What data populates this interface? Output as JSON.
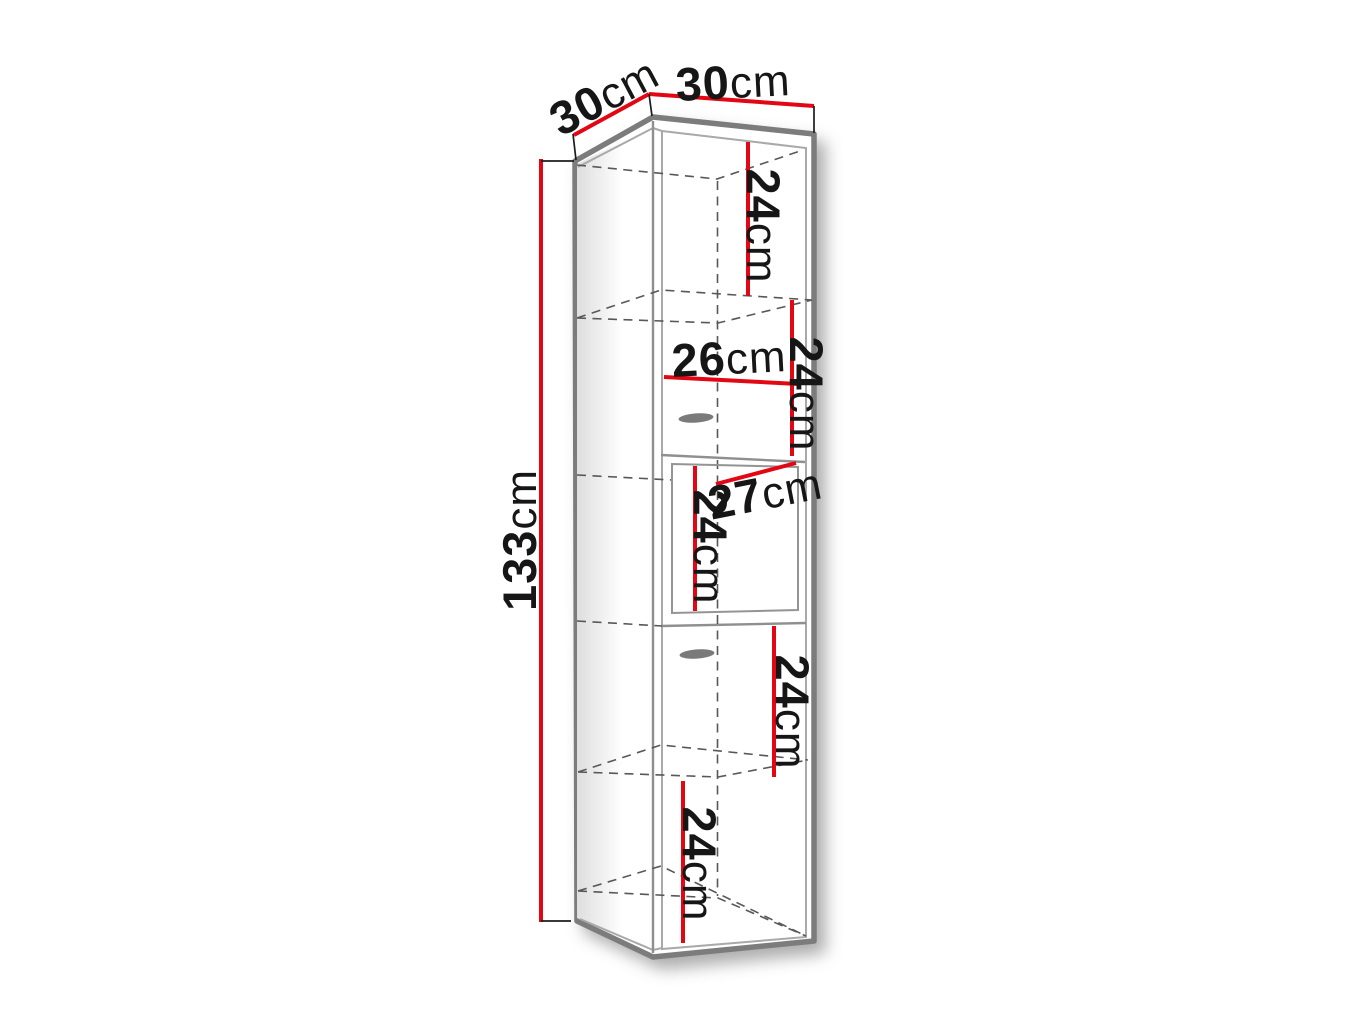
{
  "diagram": {
    "type": "furniture-dimension-drawing",
    "subject": "tall narrow cabinet with shelves, two drawers and one door, 3D view",
    "colors": {
      "dimension_line": "#e30613",
      "structure": "#7c7c7c",
      "hidden_edge": "#585858",
      "text": "#161616",
      "background": "#ffffff"
    },
    "dimensions": {
      "depth_top": {
        "value": "30",
        "unit": "cm"
      },
      "width_top": {
        "value": "30",
        "unit": "cm"
      },
      "height_overall": {
        "value": "133",
        "unit": "cm"
      },
      "section_top": {
        "value": "24",
        "unit": "cm"
      },
      "section_upper": {
        "value": "24",
        "unit": "cm"
      },
      "inner_width": {
        "value": "26",
        "unit": "cm"
      },
      "door_width": {
        "value": "27",
        "unit": "cm"
      },
      "door_height": {
        "value": "24",
        "unit": "cm"
      },
      "section_lower": {
        "value": "24",
        "unit": "cm"
      },
      "section_bottom": {
        "value": "24",
        "unit": "cm"
      }
    }
  }
}
